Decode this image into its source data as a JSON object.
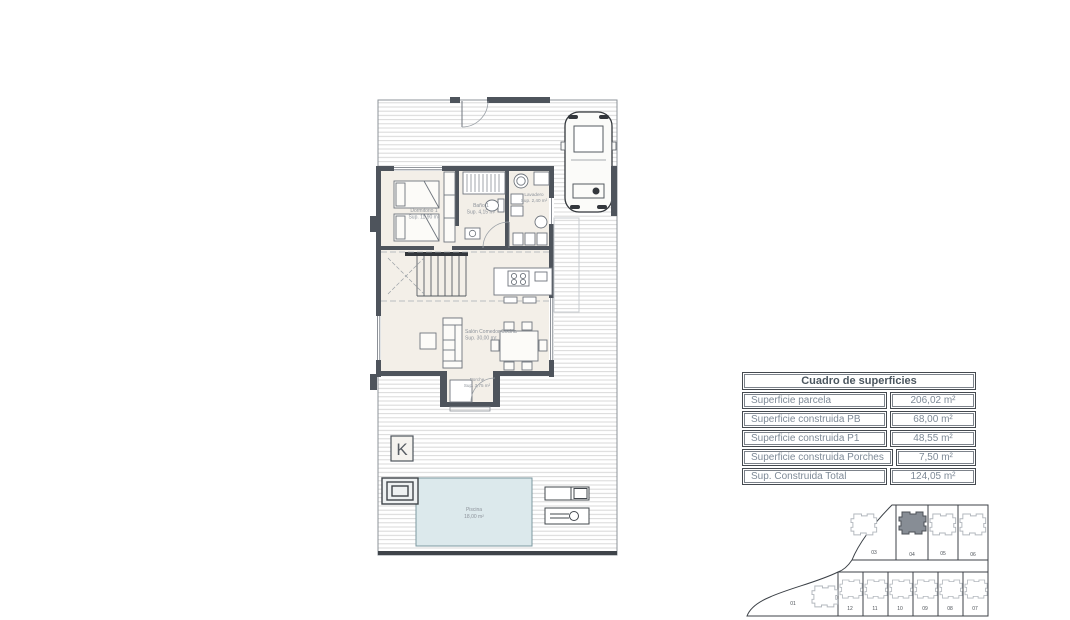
{
  "surface_table": {
    "title": "Cuadro de superficies",
    "rows": [
      {
        "label": "Superficie parcela",
        "value": "206,02 m²"
      },
      {
        "label": "Superficie construida PB",
        "value": "68,00 m²"
      },
      {
        "label": "Superficie construida P1",
        "value": "48,55 m²"
      },
      {
        "label": "Superficie construida Porches",
        "value": "7,50 m²"
      },
      {
        "label": "Sup. Construida Total",
        "value": "124,05 m²"
      }
    ]
  },
  "floorplan": {
    "logo": "K",
    "rooms": {
      "dormitorio": {
        "name": "Dormitorio 1",
        "area": "Sup. 11,90 m²"
      },
      "bano": {
        "name": "Baño 1",
        "area": "Sup. 4,15 m²"
      },
      "lavadero": {
        "name": "Lavadero",
        "area": "Sup. 2,40 m²"
      },
      "salon": {
        "name": "Salón Comedor Cocina",
        "area": "Sup. 30,00 m²"
      },
      "porche": {
        "name": "Porche",
        "area": "Sup. 3,75 m²"
      },
      "piscina": {
        "name": "Piscina",
        "area": "18,00 m²"
      }
    }
  },
  "site_plan": {
    "highlighted_plot": "04",
    "left_plot": "01",
    "top_row": [
      "03",
      "04",
      "05",
      "06"
    ],
    "bottom_row": [
      "12",
      "11",
      "10",
      "09",
      "08",
      "07"
    ]
  },
  "colors": {
    "wall": "#4e545c",
    "pool": "#dce9ec",
    "highlight": "#878d95",
    "table_text": "#7e8a97"
  }
}
